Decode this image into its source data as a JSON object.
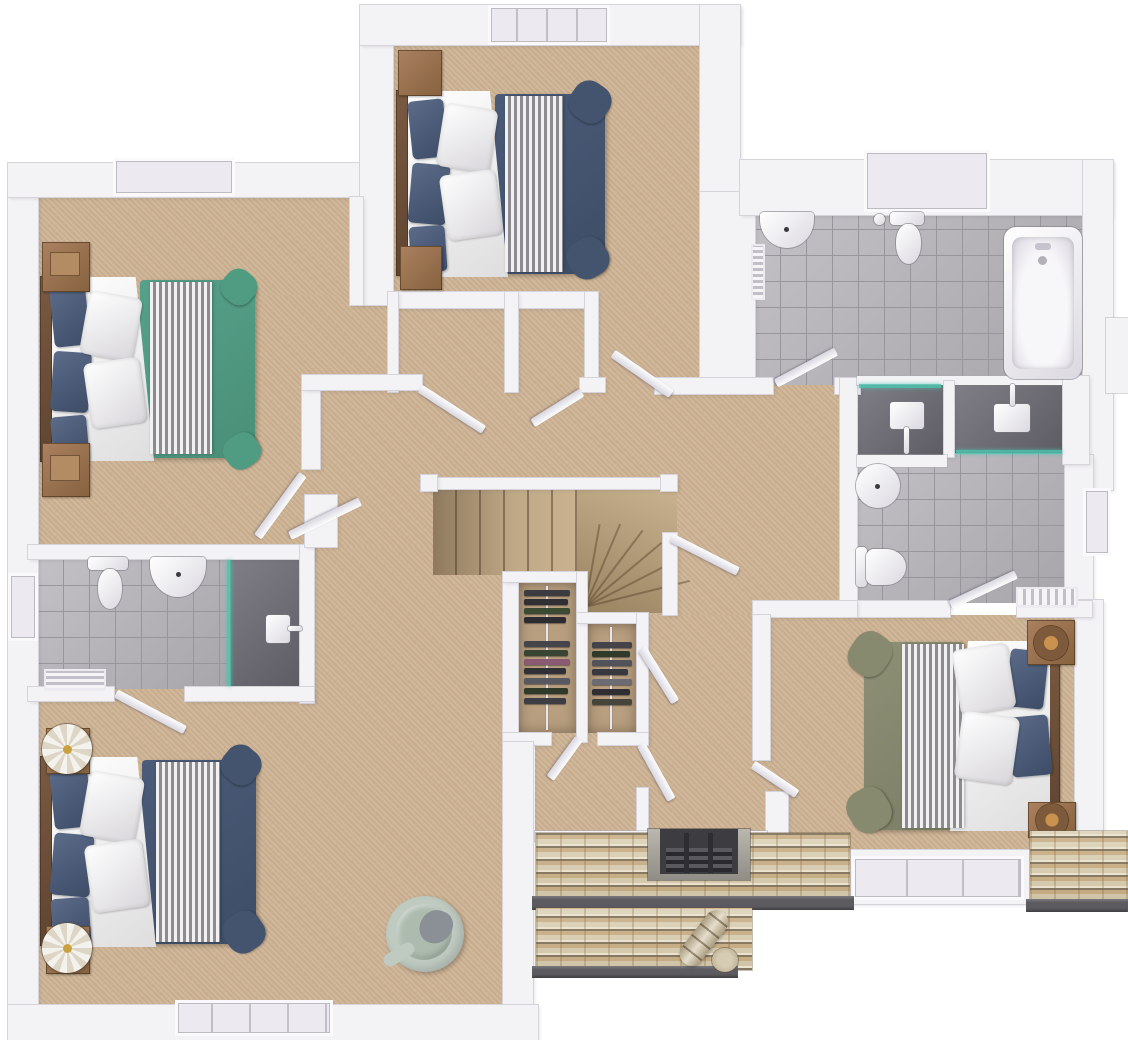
{
  "palette": {
    "wall": "#f3f2f5",
    "wall_edge": "#d6d4da",
    "carpet": "#cdb394",
    "tile": "#b6b3b9",
    "tile_line": "#98959c",
    "shower_floor": "#717079",
    "glass": "#4fc3ae",
    "teal_bed": "#57a189",
    "navy_bed": "#4b5b78",
    "olive_bed": "#8e9076",
    "pillow_navy": "#3d4d68",
    "wood": "#9a7352",
    "wood_dark": "#6e4f38",
    "stone": "#d9cfb8",
    "gutter": "#5c5b60",
    "copper": "#b0713e",
    "chair": "#bfcac1"
  },
  "scene": {
    "type": "floor-plan-3d-render",
    "view": "top-down",
    "rooms": [
      {
        "name": "bedroom-top-left",
        "floor_finish": "carpet",
        "furniture": [
          "double-bed-teal",
          "nightstand",
          "nightstand"
        ]
      },
      {
        "name": "bedroom-top-middle",
        "floor_finish": "carpet",
        "furniture": [
          "double-bed-navy",
          "bedside-chest",
          "bedside-chest",
          "built-in-closet",
          "built-in-closet"
        ]
      },
      {
        "name": "family-bathroom",
        "floor_finish": "tile",
        "fixtures": [
          "corner-basin",
          "toilet",
          "bathtub",
          "towel-rail",
          "shower-enclosure"
        ]
      },
      {
        "name": "master-ensuite",
        "floor_finish": "tile",
        "fixtures": [
          "round-basin",
          "toilet",
          "shower-enclosure",
          "towel-radiator"
        ]
      },
      {
        "name": "master-bedroom",
        "floor_finish": "carpet",
        "furniture": [
          "double-bed-olive",
          "nightstand-copper",
          "nightstand-copper"
        ]
      },
      {
        "name": "bedroom-bottom-left",
        "floor_finish": "carpet",
        "furniture": [
          "double-bed-navy",
          "round-side-table",
          "round-side-table",
          "swivel-chair"
        ]
      },
      {
        "name": "bottom-left-ensuite",
        "floor_finish": "tile",
        "fixtures": [
          "basin",
          "toilet",
          "shower-enclosure",
          "towel-bench"
        ]
      },
      {
        "name": "landing",
        "floor_finish": "carpet",
        "features": [
          "staircase-with-winders",
          "wardrobe-closet",
          "wardrobe-closet"
        ]
      }
    ],
    "exterior_features": [
      "stone-roof-sections",
      "chimney-grate",
      "rain-gutters",
      "stone-ridge-tile"
    ],
    "window_count": 7,
    "door_count": 12
  }
}
